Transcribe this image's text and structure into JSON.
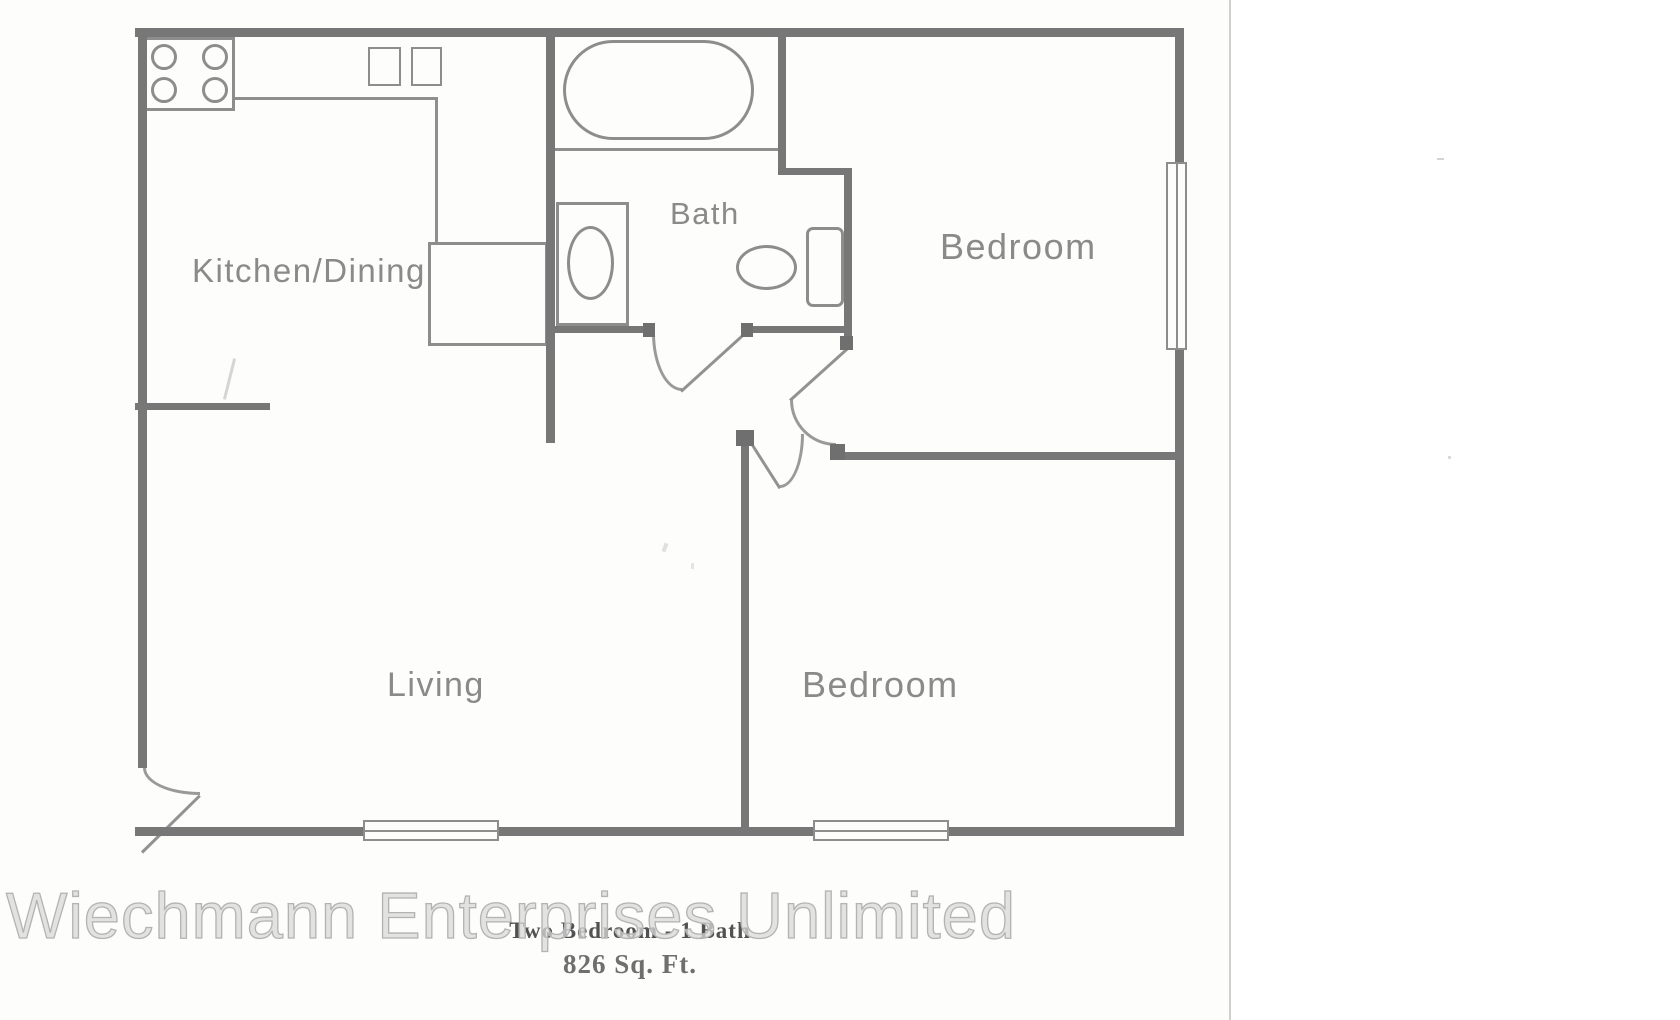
{
  "floor_plan": {
    "title": "Two Bedroom - 1 Bath",
    "subtitle": "826 Sq. Ft.",
    "watermark": "Wiechmann Enterprises Unlimited",
    "rooms": [
      {
        "name": "kitchen-dining",
        "label": "Kitchen/Dining"
      },
      {
        "name": "bath",
        "label": "Bath"
      },
      {
        "name": "bedroom-1",
        "label": "Bedroom"
      },
      {
        "name": "living",
        "label": "Living"
      },
      {
        "name": "bedroom-2",
        "label": "Bedroom"
      }
    ],
    "fixtures": [
      "stove-burners",
      "kitchen-double-sink",
      "pantry-closet",
      "bathtub",
      "vanity-sink",
      "toilet"
    ],
    "features": [
      "entry-door",
      "bath-door",
      "bedroom-1-door",
      "bedroom-2-door",
      "window-bottom-left",
      "window-bottom-right",
      "window-right"
    ],
    "colors": {
      "wall": "#777777",
      "fixture_line": "#8d8d8d",
      "room_label": "#8a8a8a",
      "caption": "#525252",
      "watermark_outline": "#b3b3b3",
      "scan_background": "#fdfdfb"
    }
  }
}
